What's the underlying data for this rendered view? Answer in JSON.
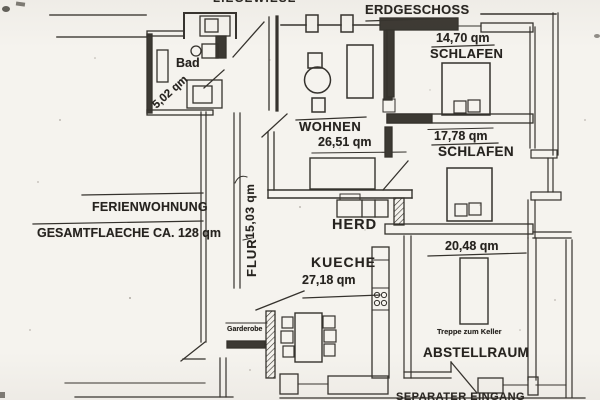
{
  "plan": {
    "header": {
      "liegewiese": "LIEGEWIESE",
      "erdgeschoss": "ERDGESCHOSS"
    },
    "rooms": {
      "bad": {
        "name": "Bad",
        "area": "5,02 qm"
      },
      "wohnen": {
        "name": "WOHNEN",
        "area": "26,51 qm"
      },
      "schlafen_nord": {
        "name": "SCHLAFEN",
        "area": "14,70 qm"
      },
      "schlafen_mitte": {
        "name": "SCHLAFEN",
        "area": "17,78 qm"
      },
      "flur": {
        "name": "FLUR",
        "area": "15,03 qm"
      },
      "kueche": {
        "name": "KUECHE",
        "area": "27,18 qm"
      },
      "abstellraum": {
        "name": "ABSTELLRAUM",
        "area": "20,48 qm"
      }
    },
    "annotations": {
      "ferienwohnung": "FERIENWOHNUNG",
      "gesamtflaeche": "GESAMTFLAECHE CA. 128 qm",
      "herd": "HERD",
      "garderobe": "Garderobe",
      "treppe_zum_keller": "Treppe zum Keller",
      "eingang": "SEPARATER EINGANG"
    },
    "colors": {
      "paper": "#f5f3ee",
      "ink": "#35322d",
      "wall_fill": "#3c3933"
    }
  }
}
